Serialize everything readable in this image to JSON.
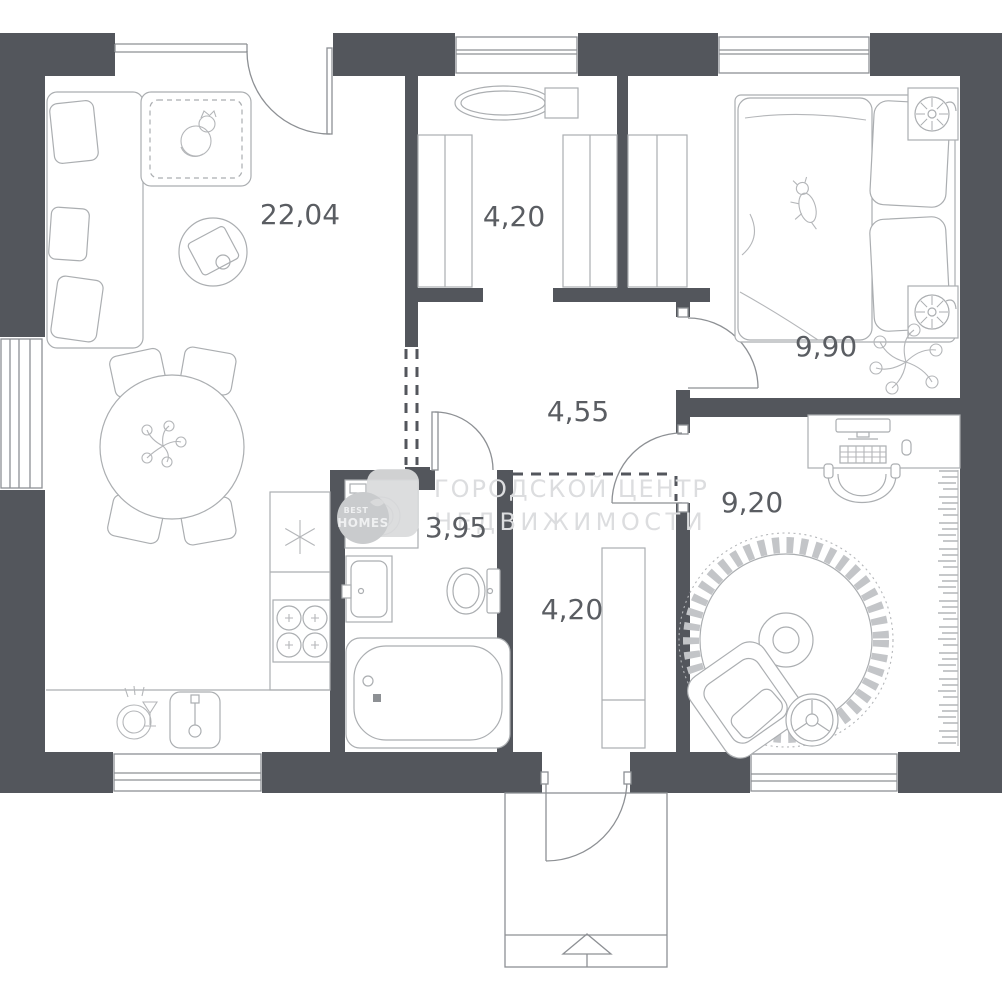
{
  "plan": {
    "type": "apartment-floor-plan",
    "rooms": [
      {
        "id": "living-room-kitchen",
        "area": "22,04"
      },
      {
        "id": "dressing-room",
        "area": "4,20"
      },
      {
        "id": "bedroom",
        "area": "9,90"
      },
      {
        "id": "corridor",
        "area": "4,55"
      },
      {
        "id": "office",
        "area": "9,20"
      },
      {
        "id": "bathroom",
        "area": "3,95"
      },
      {
        "id": "entrance-hall",
        "area": "4,20"
      }
    ],
    "watermark": {
      "line1": "ГОРОДСКОЙ ЦЕНТР",
      "line2": "НЕДВИЖИМОСТИ"
    },
    "logo": {
      "word1": "BEST",
      "word2": "HOMES"
    },
    "icons": {
      "fridge": "snowflake-icon",
      "entrance": "up-arrow-icon",
      "dishwasher": "dishwasher-icon"
    },
    "colors": {
      "wall": "#53565c",
      "fixture_line": "#8d9094",
      "furniture_line": "#abaeb1",
      "label": "#5a5d62",
      "watermark": "#dcdddf",
      "logo_tile": "#d9dadb",
      "logo_circle": "#c9cbcd"
    }
  }
}
